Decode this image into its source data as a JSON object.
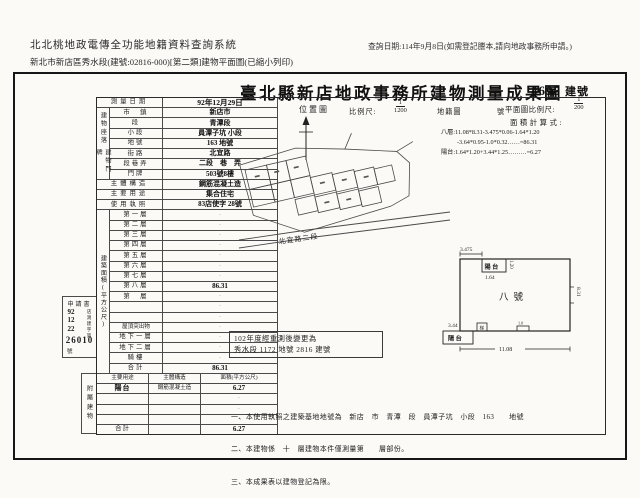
{
  "header": {
    "system_title": "北北桃地政電傳全功能地籍資料查詢系統",
    "query_date": "查詢日期:114年9月8日(如需登記謄本,請向地政事務所申請。)",
    "subtitle": "新北市新店區秀水段(建號:02816-000)[第二類]建物平面圖(已縮小列印)"
  },
  "document": {
    "title": "臺北縣新店地政事務所建物測量成果圖",
    "building_number": "4695",
    "building_number_unit": "建號"
  },
  "form": {
    "groups": {
      "site": "建物座落",
      "door": "建物門牌",
      "area": "建築面積(平方公尺)",
      "annex": "附屬建物"
    },
    "rows": [
      {
        "label": "測量日期",
        "value": "92年12月29日"
      },
      {
        "label": "市　鎮",
        "value": "新店市"
      },
      {
        "label": "段",
        "value": "青潭段"
      },
      {
        "label": "小段",
        "value": "員潭子坑 小段"
      },
      {
        "label": "地號",
        "value": "163 地號"
      },
      {
        "label": "街路",
        "value": "北宜路"
      },
      {
        "label": "段巷弄",
        "value": "二段　巷　弄"
      },
      {
        "label": "門牌",
        "value": "503號8樓"
      },
      {
        "label": "主體構造",
        "value": "鋼筋混凝土造"
      },
      {
        "label": "主要用途",
        "value": "集合住宅"
      },
      {
        "label": "使用執照",
        "value": "83店使字 28號"
      }
    ],
    "floors": [
      {
        "label": "第一層",
        "value": "·"
      },
      {
        "label": "第二層",
        "value": "·"
      },
      {
        "label": "第三層",
        "value": "·"
      },
      {
        "label": "第四層",
        "value": "·"
      },
      {
        "label": "第五層",
        "value": "·"
      },
      {
        "label": "第六層",
        "value": "·"
      },
      {
        "label": "第七層",
        "value": "·"
      },
      {
        "label": "第八層",
        "value": "86.31"
      },
      {
        "label": "第　層",
        "value": "·"
      },
      {
        "label": "",
        "value": "·"
      },
      {
        "label": "",
        "value": "·"
      },
      {
        "label": "屋頂突出物",
        "value": "·"
      },
      {
        "label": "地下一層",
        "value": "·"
      },
      {
        "label": "地下二層",
        "value": "·"
      },
      {
        "label": "騎樓",
        "value": "·"
      },
      {
        "label": "合計",
        "value": "86.31"
      }
    ],
    "annex": {
      "headers": [
        "主要用途",
        "主體構造",
        "面積(平方公尺)"
      ],
      "rows": [
        [
          "陽台",
          "鋼筋混凝土造",
          "6.27"
        ],
        [
          "",
          "",
          "·"
        ],
        [
          "",
          "",
          "·"
        ],
        [
          "",
          "",
          "·"
        ],
        [
          "合計",
          "",
          "6.27"
        ]
      ]
    }
  },
  "application": {
    "label": "申請書",
    "date": {
      "y": "92",
      "m": "12",
      "d": "22"
    },
    "agency": "店測建",
    "zi": "字",
    "di": "第",
    "number": "26010",
    "hao": "號"
  },
  "location_map": {
    "label": "位置圖",
    "scale_label": "比例尺:",
    "scale_num": "1",
    "scale_den": "1200",
    "map_label": "地籍圖",
    "no_label": "號",
    "road": "北宜路二段"
  },
  "plan": {
    "scale_label": "平面圖比例尺:",
    "scale_num": "1",
    "scale_den": "200",
    "calc_label": "面積計算式:",
    "calc_lines": [
      "八層:11.08*8.31-3.475*0.06-1.64*1.20",
      "-3.64*0.95-1.0*0.32……=86.31",
      "陽台:1.64*1.20+3.44*1.25………=6.27"
    ],
    "unit_label": "八號",
    "balcony_label": "陽台",
    "stair_label": "梯",
    "dims": {
      "top_left": "3.475",
      "balcony_top_w": "1.64",
      "balcony_top_d": "1.20",
      "balcony_bottom_w": "3.44",
      "bottom": "11.08",
      "right": "8.31",
      "notch": "1.0"
    }
  },
  "resurvey_stamp": {
    "line1": "102年度經重測後變更為",
    "line2": "秀水段 1172 地號 2816 建號"
  },
  "notes": {
    "n1": "一、本使用執照之建築基地地號為　新店　市　青潭　段　員潭子坑　小段　163　　地號",
    "n2": "二、本建物係　十　層建物本件僅測量第　　層部份。",
    "n3": "三、本成果表以建物登記為限。"
  }
}
